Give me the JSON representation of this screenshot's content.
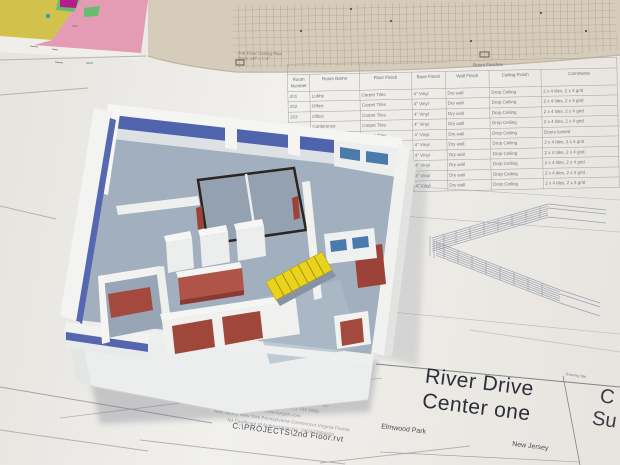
{
  "colors": {
    "accent_blue": "#5064ad",
    "model_red": "#a0473c",
    "model_yellow": "#e9d31d",
    "floor_slate": "#a2afbf",
    "paper_beige": "#d6ccbc",
    "window_blue": "#4b7aad"
  },
  "ceiling_plan_caption": {
    "line1": "2nd Floor Ceiling Plan",
    "line2": "Scale: 1/8\" = 1'-0\""
  },
  "schedule": {
    "super": [
      [
        "",
        2
      ],
      [
        "Room Finishes",
        5
      ]
    ],
    "columns": [
      "Room Number",
      "Room Name",
      "Floor Finish",
      "Base Finish",
      "Wall Finish",
      "Ceiling Finish",
      "Comments"
    ],
    "rows": [
      [
        "201",
        "Lobby",
        "Carpet Tiles",
        "4\" Vinyl",
        "Dry wall",
        "Drop Ceiling",
        "2 x 4 tiles, 2 x 4 grid"
      ],
      [
        "202",
        "Office",
        "Carpet Tiles",
        "4\" Vinyl",
        "Dry wall",
        "Drop Ceiling",
        "2 x 4 tiles, 2 x 4 grid"
      ],
      [
        "203",
        "Office",
        "Carpet Tiles",
        "4\" Vinyl",
        "Dry wall",
        "Drop Ceiling",
        "2 x 4 tiles, 2 x 4 grid"
      ],
      [
        "204",
        "Conference",
        "Carpet Tiles",
        "4\" Vinyl",
        "Dry wall",
        "Drop Ceiling",
        "2 x 4 tiles, 2 x 4 grid"
      ],
      [
        "205",
        "Corridor",
        "Carpet Tiles",
        "4\" Vinyl",
        "Dry wall",
        "Drop Ceiling",
        "Doors locked"
      ],
      [
        "206",
        "Storage",
        "Vinyl Tiles",
        "4\" Vinyl",
        "Dry wall",
        "Drop Ceiling",
        "2 x 4 tiles, 2 x 4 grid"
      ],
      [
        "207",
        "Office",
        "Carpet Tiles",
        "4\" Vinyl",
        "Dry wall",
        "Drop Ceiling",
        "2 x 4 tiles, 2 x 4 grid"
      ],
      [
        "208",
        "Office",
        "Carpet Tiles",
        "4\" Vinyl",
        "Dry wall",
        "Drop Ceiling",
        "2 x 4 tiles, 2 x 4 grid"
      ],
      [
        "209",
        "Office",
        "Carpet Tiles",
        "4\" Vinyl",
        "Dry wall",
        "Drop Ceiling",
        "2 x 4 tiles, 2 x 4 grid"
      ],
      [
        "210",
        "Office",
        "Carpet Tiles",
        "4\" Vinyl",
        "Dry wall",
        "Drop Ceiling",
        "2 x 4 tiles, 2 x 4 grid"
      ]
    ]
  },
  "firm_block": {
    "address": "619 River Drive, Elmwood Park, NJ 07407",
    "phone_fax": "T: 201 794 6900      F: 201 794 6988",
    "website": "www.langan.com",
    "offices": "New Jersey      New York      Pennsylvania      Connecticut      Virginia      Florida",
    "certificate": "NJ Certificate of Authorization No. 24GA27996600",
    "file_path": "C:\\PROJECTS\\2nd Floor.rvt"
  },
  "title_block": {
    "project_name_line1": "River Drive",
    "project_name_line2": "Center one",
    "city": "Elmwood Park",
    "state": "New Jersey",
    "drawing_title_label": "Drawing Title",
    "drawing_title_partial_line1": "C",
    "drawing_title_partial_line2": "Su"
  }
}
